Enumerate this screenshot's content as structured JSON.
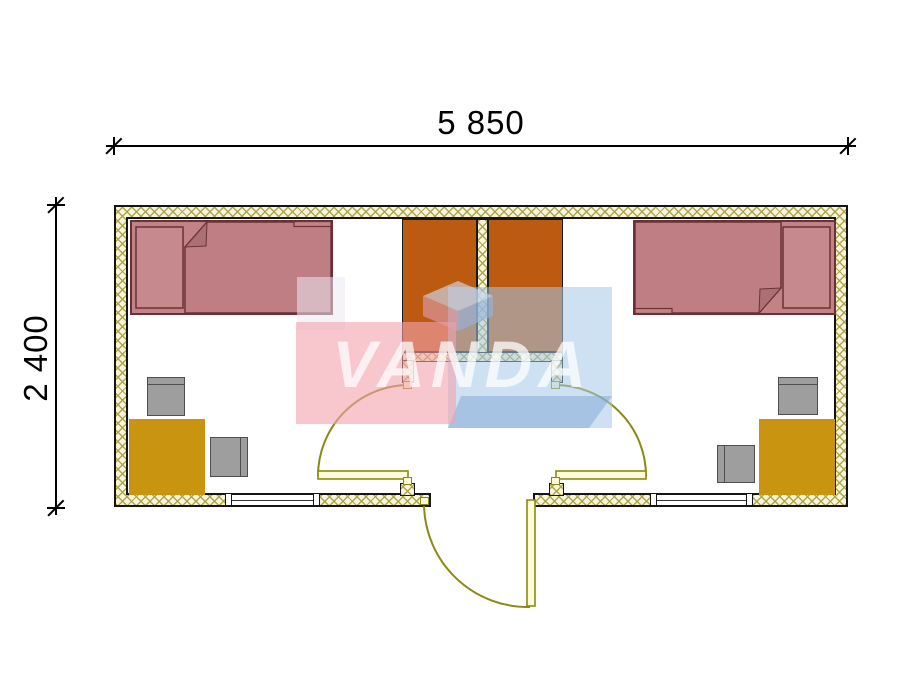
{
  "drawing": {
    "type": "floor-plan",
    "watermark": {
      "text": "VANDA",
      "pink": "#f2a2ae",
      "blue": "#a6c8e8"
    },
    "dimensions": {
      "width_label": "5 850",
      "height_label": "2 400"
    },
    "colors": {
      "wall_fill": "#f8f5da",
      "wall_hatch_line": "#aba348",
      "wall_outline": "#151515",
      "wardrobe": "#bc5a12",
      "bed_fill": "#c28287",
      "bed_outline": "#6b3136",
      "desk": "#c99510",
      "chair": "#9e9e9e",
      "chair_outline": "#4f4f4f",
      "door_line": "#8a8a10",
      "door_leaf_fill": "#fdfbd8",
      "dimension_text": "#000000"
    },
    "contents": {
      "beds": 2,
      "wardrobes": 2,
      "desks": 2,
      "chairs": 4,
      "doors": 3,
      "windows": 2
    }
  }
}
